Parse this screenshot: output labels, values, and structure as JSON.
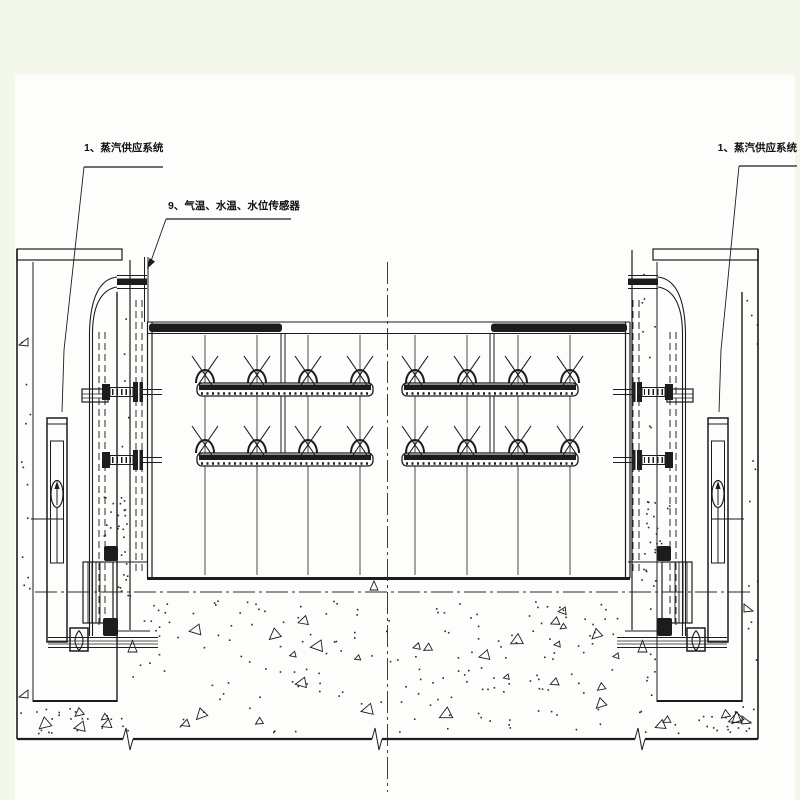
{
  "colors": {
    "page_background": "#f4f7ec",
    "canvas_background": "#fdfdfb",
    "ink": "#1c1c1c"
  },
  "annotations": {
    "steam_supply_left": {
      "label": "1、蒸汽供应系统"
    },
    "sensors": {
      "label": "9、气温、水温、水位传感器"
    },
    "steam_supply_right": {
      "label": "1、蒸汽供应系统"
    }
  }
}
